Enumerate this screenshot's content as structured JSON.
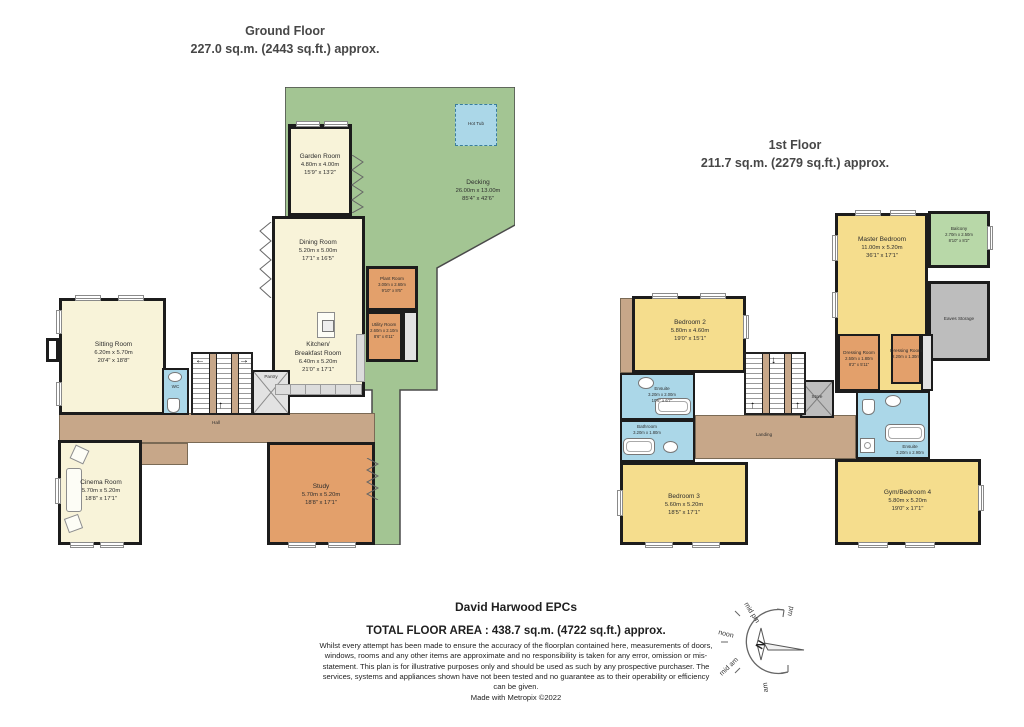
{
  "ground_floor": {
    "title": "Ground Floor",
    "subtitle": "227.0 sq.m. (2443 sq.ft.) approx.",
    "rooms": {
      "garden": {
        "name": "Garden Room",
        "m": "4.80m  x 4.00m",
        "ft": "15'9\"  x 13'2\""
      },
      "decking": {
        "name": "Decking",
        "m": "26.00m  x 13.00m",
        "ft": "85'4\"  x 42'6\""
      },
      "hot_tub": {
        "name": "Hot Tub"
      },
      "dining": {
        "name": "Dining Room",
        "m": "5.20m  x 5.00m",
        "ft": "17'1\"  x 16'5\""
      },
      "kitchen": {
        "name": "Kitchen/",
        "name2": "Breakfast Room",
        "m": "6.40m  x 5.20m",
        "ft": "21'0\"  x 17'1\""
      },
      "sitting": {
        "name": "Sitting Room",
        "m": "6.20m  x 5.70m",
        "ft": "20'4\"  x 18'8\""
      },
      "cinema": {
        "name": "Cinema Room",
        "m": "5.70m  x 5.20m",
        "ft": "18'8\"  x 17'1\""
      },
      "study": {
        "name": "Study",
        "m": "5.70m  x 5.20m",
        "ft": "18'8\"  x 17'1\""
      },
      "plant": {
        "name": "Plant Room",
        "m": "3.00m x 2.60m",
        "ft": "9'10\" x 8'6\""
      },
      "utility": {
        "name": "Utility Room",
        "m": "2.60m x 2.10m",
        "ft": "8'6\" x 6'11\""
      },
      "wc": {
        "name": "WC"
      },
      "pantry": {
        "name": "Pantry"
      },
      "hall": {
        "name": "Hall"
      }
    }
  },
  "first_floor": {
    "title": "1st Floor",
    "subtitle": "211.7 sq.m. (2279 sq.ft.) approx.",
    "rooms": {
      "master": {
        "name": "Master Bedroom",
        "m": "11.00m  x 5.20m",
        "ft": "36'1\"  x 17'1\""
      },
      "balcony": {
        "name": "Balcony",
        "m": "2.70m x 2.50m",
        "ft": "8'10\" x 8'2\""
      },
      "eaves": {
        "name": "Eaves Storage"
      },
      "bedroom2": {
        "name": "Bedroom 2",
        "m": "5.80m  x 4.60m",
        "ft": "19'0\"  x 15'1\""
      },
      "bedroom3": {
        "name": "Bedroom 3",
        "m": "5.60m  x 5.20m",
        "ft": "18'5\"  x 17'1\""
      },
      "gym": {
        "name": "Gym/Bedroom 4",
        "m": "5.80m  x 5.20m",
        "ft": "19'0\"  x 17'1\""
      },
      "dressing1": {
        "name": "Dressing Room",
        "m": "2.50m x 1.80m",
        "ft": "8'2\" x 5'11\""
      },
      "dressing2": {
        "name": "Dressing Room",
        "m": "2.20m x 1.30m",
        "ft": "7'3\" x 4'3\""
      },
      "ensuite_master": {
        "name": "Ensuite",
        "m": "3.20m x 2.90m",
        "ft": "10'6\" x 9'6\""
      },
      "ensuite2": {
        "name": "Ensuite",
        "m": "3.20m x 2.00m",
        "ft": "10'6\" x 6'7\""
      },
      "bathroom": {
        "name": "Bathroom",
        "m": "3.20m x 1.80m",
        "ft": "10'6\" x 5'11\""
      },
      "store": {
        "name": "Store"
      },
      "landing": {
        "name": "Landing"
      }
    }
  },
  "footer": {
    "company": "David Harwood EPCs",
    "total": "TOTAL FLOOR AREA : 438.7 sq.m. (4722 sq.ft.) approx.",
    "disclaimer": "Whilst every attempt has been made to ensure the accuracy of the floorplan contained here, measurements of doors, windows, rooms and any other items are approximate and no responsibility is taken for any error, omission or mis-statement. This plan is for illustrative purposes only and should be used as such by any prospective purchaser. The services, systems and appliances shown have not been tested and no guarantee as to their operability or efficiency can be given.",
    "made_with": "Made with Metropix ©2022"
  },
  "compass": {
    "north": "N",
    "labels": {
      "pm": "pm",
      "mid_pm": "mid pm",
      "noon": "noon",
      "mid_am": "mid am",
      "am": "am"
    }
  }
}
